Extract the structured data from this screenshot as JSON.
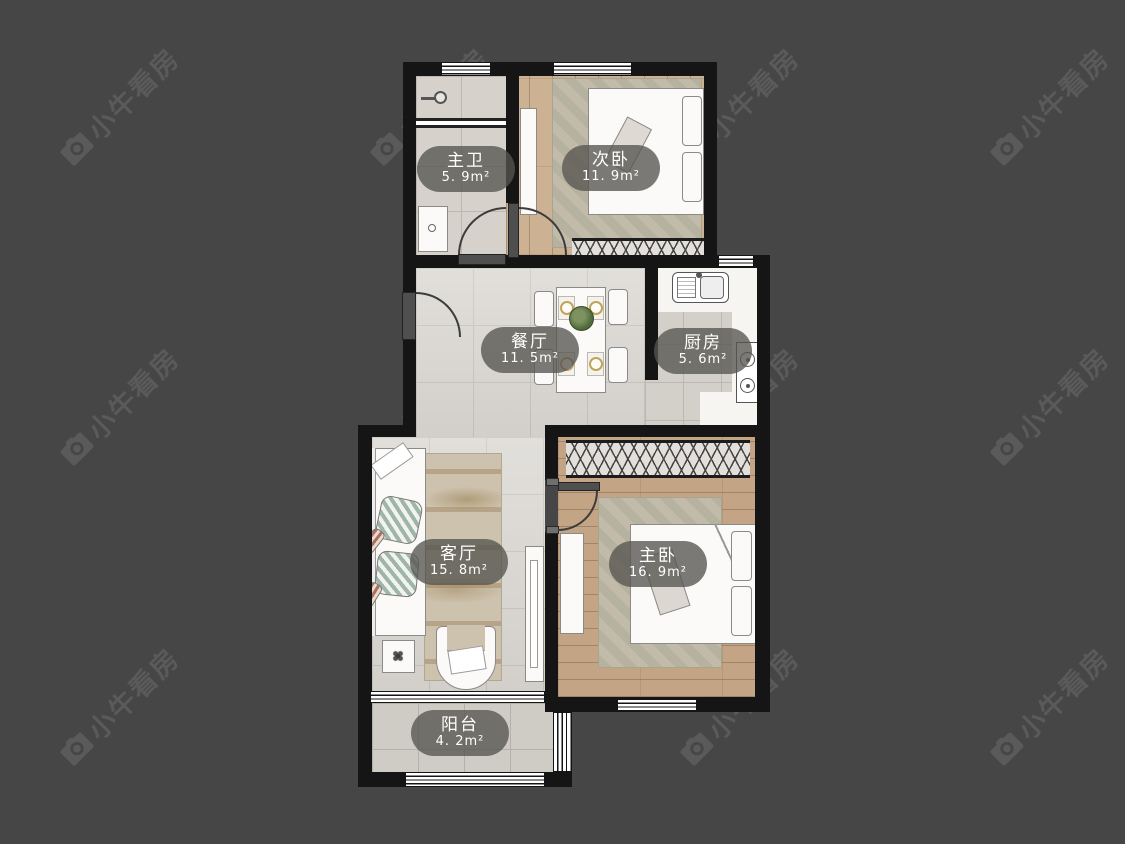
{
  "canvas": {
    "width": 1125,
    "height": 844,
    "background": "#464646"
  },
  "watermark": {
    "text": "小牛看房",
    "icon": "camera-icon",
    "color": "#5a5a5a"
  },
  "rooms": [
    {
      "id": "master-bath",
      "name": "主卫",
      "area": "5. 9m²"
    },
    {
      "id": "second-bedroom",
      "name": "次卧",
      "area": "11. 9m²"
    },
    {
      "id": "dining-room",
      "name": "餐厅",
      "area": "11. 5m²"
    },
    {
      "id": "kitchen",
      "name": "厨房",
      "area": "5. 6m²"
    },
    {
      "id": "living-room",
      "name": "客厅",
      "area": "15. 8m²"
    },
    {
      "id": "master-bedroom",
      "name": "主卧",
      "area": "16. 9m²"
    },
    {
      "id": "balcony",
      "name": "阳台",
      "area": "4. 2m²"
    }
  ],
  "colors": {
    "background": "#464646",
    "wall": "#151515",
    "watermark": "#5a5a5a",
    "label_bubble": "rgba(86,84,80,0.78)",
    "wood_floor": "#cbb192",
    "tile_floor": "#d6d2cb"
  }
}
